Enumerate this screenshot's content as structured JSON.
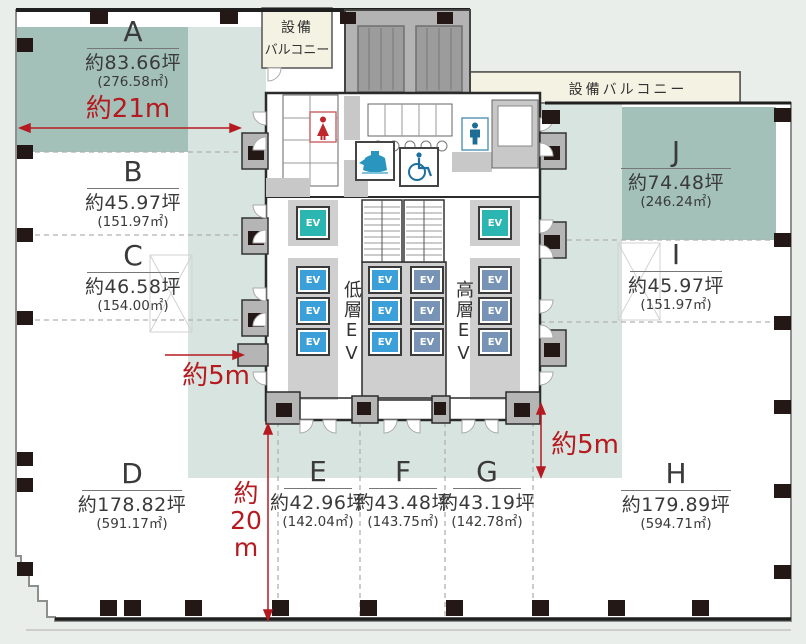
{
  "sections": [
    {
      "id": "A",
      "label": "A",
      "area_tsubo": "約83.66坪",
      "area_m2": "(276.58㎡)"
    },
    {
      "id": "B",
      "label": "B",
      "area_tsubo": "約45.97坪",
      "area_m2": "(151.97㎡)"
    },
    {
      "id": "C",
      "label": "C",
      "area_tsubo": "約46.58坪",
      "area_m2": "(154.00㎡)"
    },
    {
      "id": "D",
      "label": "D",
      "area_tsubo": "約178.82坪",
      "area_m2": "(591.17㎡)"
    },
    {
      "id": "E",
      "label": "E",
      "area_tsubo": "約42.96坪",
      "area_m2": "(142.04㎡)"
    },
    {
      "id": "F",
      "label": "F",
      "area_tsubo": "約43.48坪",
      "area_m2": "(143.75㎡)"
    },
    {
      "id": "G",
      "label": "G",
      "area_tsubo": "約43.19坪",
      "area_m2": "(142.78㎡)"
    },
    {
      "id": "H",
      "label": "H",
      "area_tsubo": "約179.89坪",
      "area_m2": "(594.71㎡)"
    },
    {
      "id": "I",
      "label": "I",
      "area_tsubo": "約45.97坪",
      "area_m2": "(151.97㎡)"
    },
    {
      "id": "J",
      "label": "J",
      "area_tsubo": "約74.48坪",
      "area_m2": "(246.24㎡)"
    }
  ],
  "dimensions": {
    "top_width": "約21m",
    "left_core_offset": "約5m",
    "right_core_offset": "約5m",
    "bottom_depth_chars": [
      "約",
      "20",
      "m"
    ]
  },
  "balconies": {
    "top_left_line1": "設備",
    "top_left_line2": "バルコニー",
    "top_right": "設備バルコニー"
  },
  "core": {
    "ev_label": "EV",
    "low_rise_bank": "低層EV",
    "high_rise_bank": "高層EV"
  },
  "icons": {
    "female_restroom": "female-restroom-icon",
    "male_restroom": "male-restroom-icon",
    "kettle": "kettle-icon",
    "wheelchair": "accessible-restroom-icon"
  },
  "colors": {
    "section_teal": "#a3c1b9",
    "zone_light": "#d8e4df",
    "balcony_cream": "#f4f2e2",
    "dimension_red": "#b51a20",
    "ev_low_rise": "#3ba0da",
    "ev_high_rise": "#7793b5",
    "ev_shuttle": "#2bb6b2",
    "column_black": "#231815",
    "outside_bg": "#e9eeea"
  }
}
